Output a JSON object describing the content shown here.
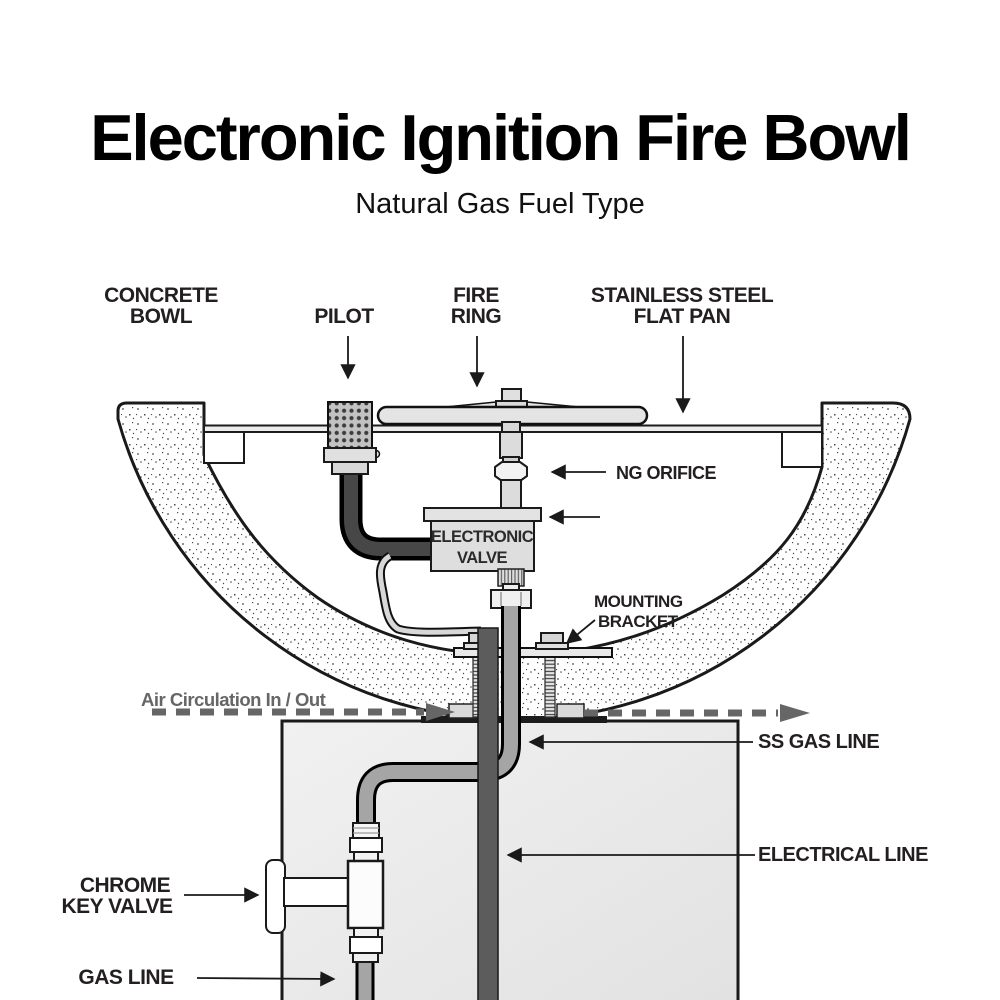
{
  "title": "Electronic Ignition Fire Bowl",
  "subtitle": "Natural Gas Fuel Type",
  "labels": {
    "concrete_bowl": [
      "CONCRETE",
      "BOWL"
    ],
    "pilot": "PILOT",
    "fire_ring": [
      "FIRE",
      "RING"
    ],
    "flat_pan": [
      "STAINLESS STEEL",
      "FLAT PAN"
    ],
    "ng_orifice": "NG ORIFICE",
    "electronic_valve": [
      "ELECTRONIC",
      "VALVE"
    ],
    "mounting_bracket": [
      "MOUNTING",
      "BRACKET"
    ],
    "air_circulation": "Air Circulation In / Out",
    "ss_gas_line": "SS GAS LINE",
    "electrical_line": "ELECTRICAL  LINE",
    "chrome_key_valve": [
      "CHROME",
      "KEY VALVE"
    ],
    "gas_line": "GAS LINE"
  },
  "colors": {
    "label_text": "#231f20",
    "air_flow_gray": "#666666",
    "pipe_gray": "#a5a5a5",
    "electrical_conduit_gray": "#5c5c5c",
    "metal_light": "#e0e0e0",
    "outline": "#1a1a1a",
    "pedestal_fill": "#ececec"
  }
}
